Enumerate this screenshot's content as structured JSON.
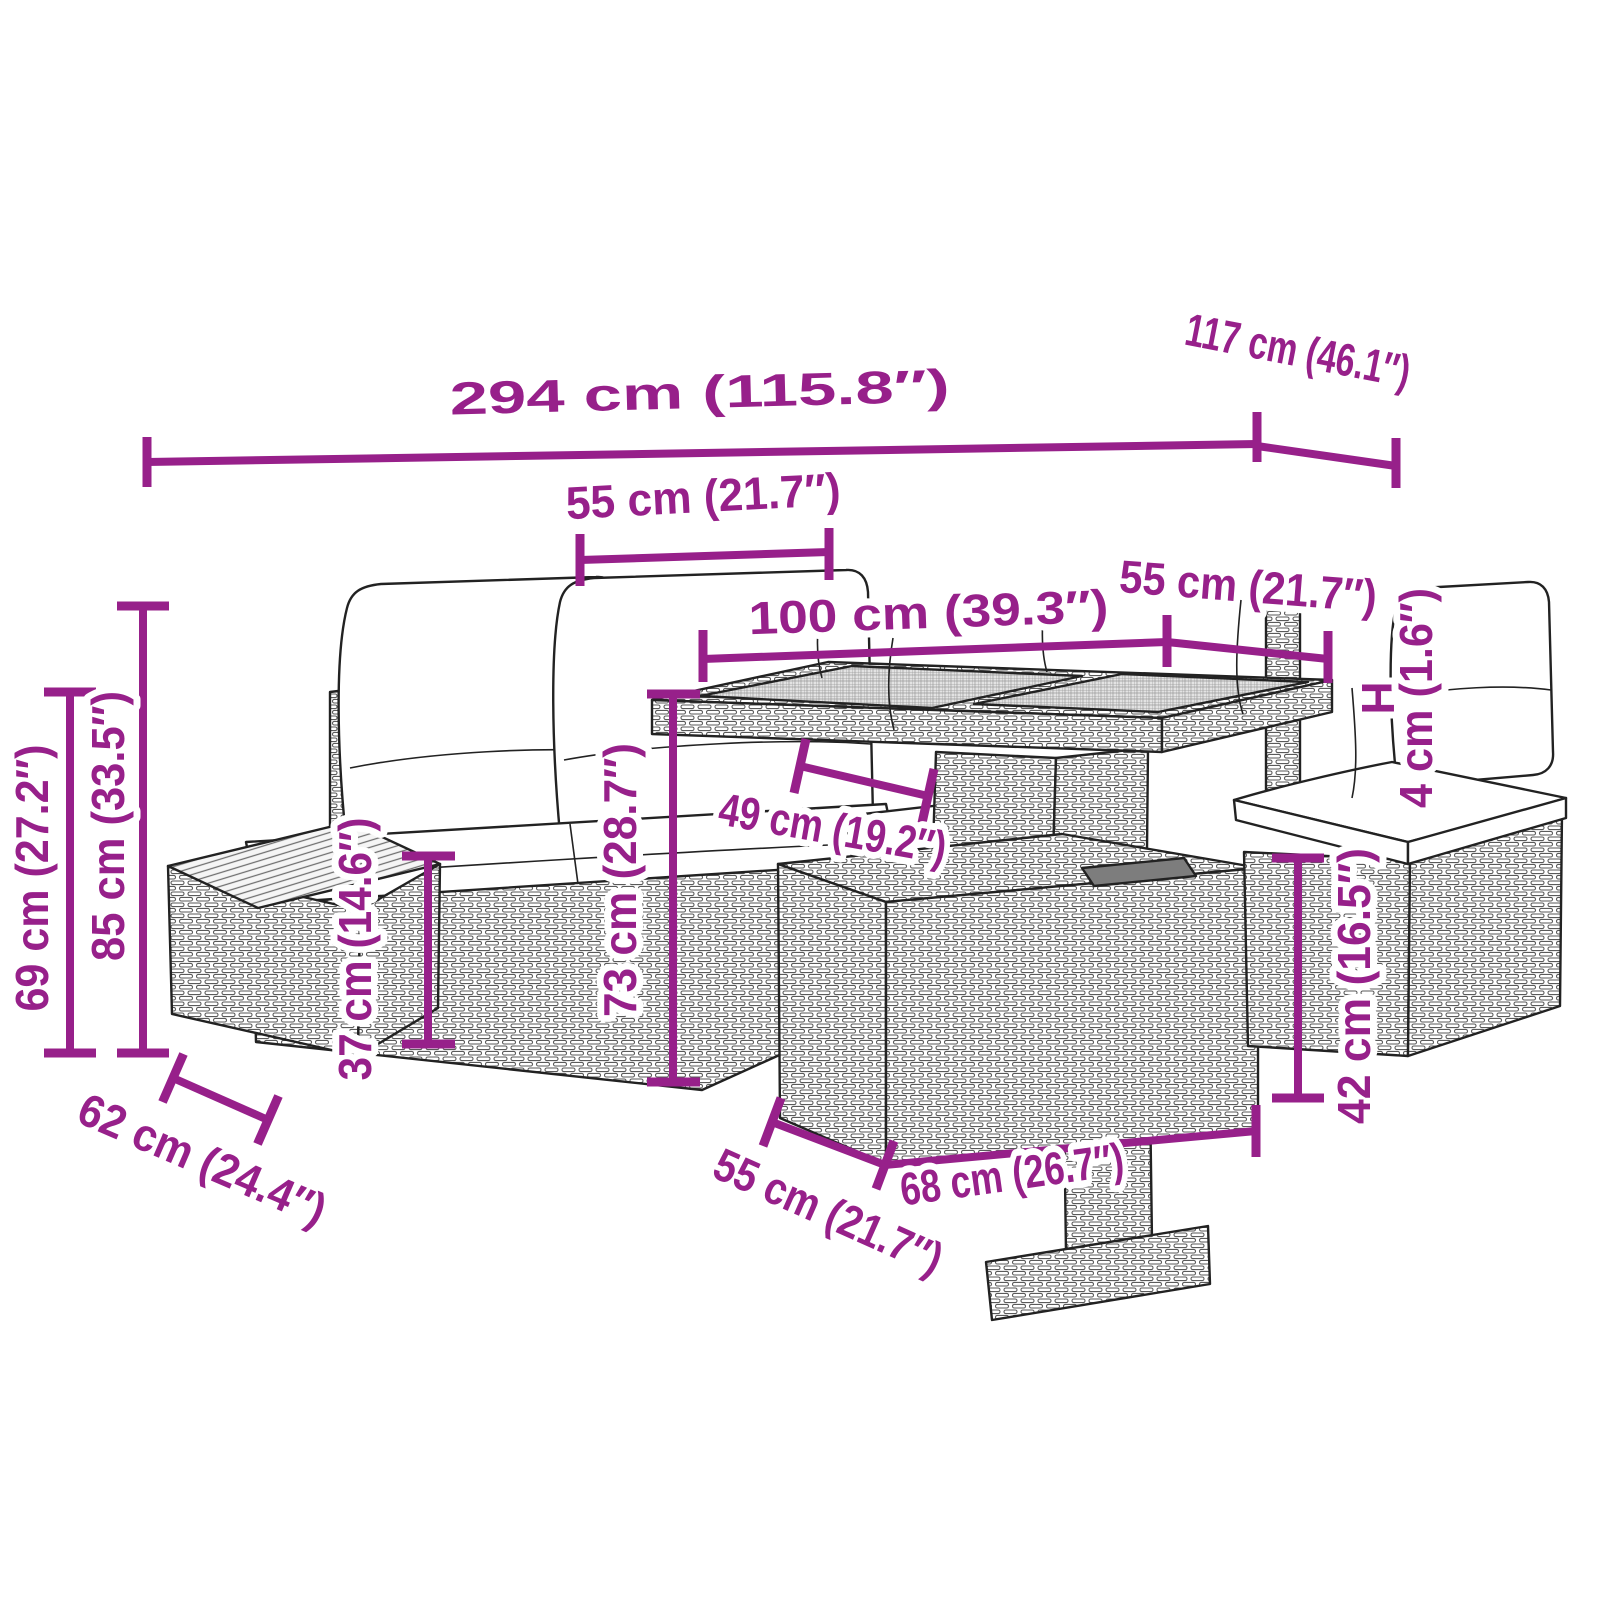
{
  "diagram": {
    "accent_color": "#97208A",
    "sketch_color": "#222222",
    "background_color": "#FFFFFF",
    "subject": "modular-garden-lounge-set-line-drawing",
    "labels": {
      "total_width": "294 cm (115.8″)",
      "total_depth": "117 cm (46.1″)",
      "seat_width_top": "55 cm (21.7″)",
      "table_length": "100 cm (39.3″)",
      "table_depth": "55 cm (21.7″)",
      "tabletop_symbol": "H",
      "tabletop_thickness": "4 cm (1.6″)",
      "height_left_outer": "69 cm (27.2″)",
      "height_back": "85 cm (33.5″)",
      "seat_height": "37 cm (14.6″)",
      "table_height": "73 cm (28.7″)",
      "table_base_width": "49 cm (19.2″)",
      "side_table_depth": "62 cm (24.4″)",
      "box_depth": "55 cm (21.7″)",
      "box_width": "68 cm (26.7″)",
      "box_height": "42 cm (16.5″)"
    }
  }
}
